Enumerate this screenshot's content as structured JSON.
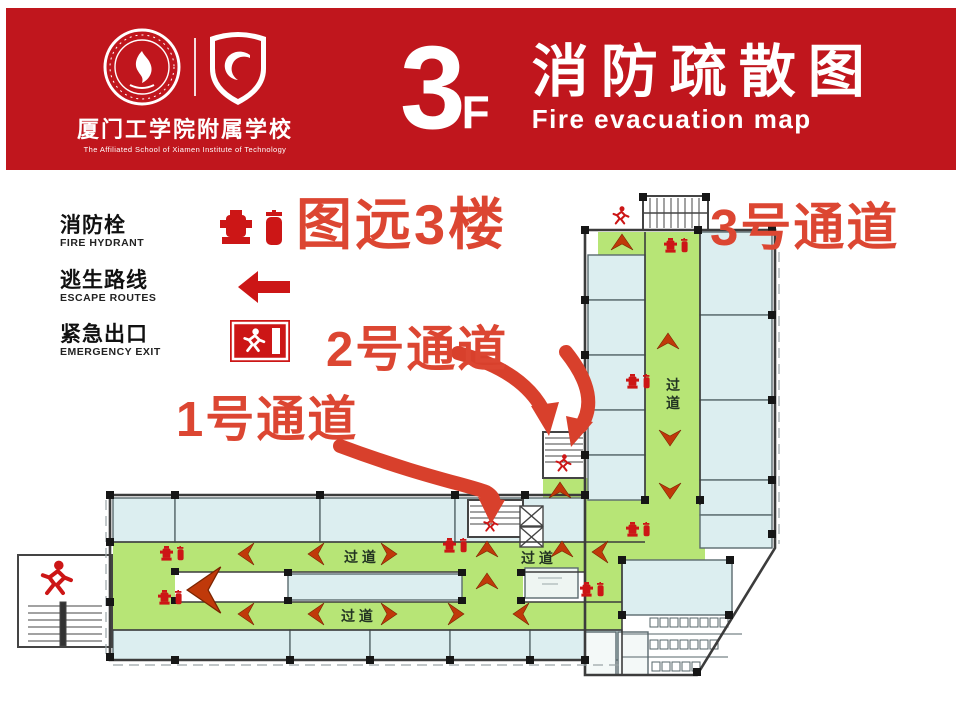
{
  "header": {
    "floor_number": "3",
    "floor_letter": "F",
    "title_zh": "消防疏散图",
    "title_en": "Fire evacuation map",
    "school_zh": "厦门工学院附属学校",
    "school_en": "The Affiliated School of Xiamen Institute of Technology"
  },
  "legend": {
    "items": [
      {
        "zh": "消防栓",
        "en": "FIRE HYDRANT",
        "icon": "fire-hydrant-extinguisher-icon"
      },
      {
        "zh": "逃生路线",
        "en": "ESCAPE ROUTES",
        "icon": "escape-route-arrow-icon"
      },
      {
        "zh": "紧急出口",
        "en": "EMERGENCY EXIT",
        "icon": "emergency-exit-icon"
      }
    ]
  },
  "annotations": {
    "floor_note": "图远3楼",
    "channel_3": "3号通道",
    "channel_2": "2号通道",
    "channel_1": "1号通道"
  },
  "plan": {
    "corridor_label": "过 道",
    "corridor_vertical_char1": "过",
    "corridor_vertical_char2": "道",
    "colors": {
      "header_red": "#c0161d",
      "annotation_red": "#dc4632",
      "corridor_green": "#b7e576",
      "room_blue": "#dceef0",
      "route_arrow": "#c0390a",
      "icon_red": "#cc1616"
    }
  }
}
